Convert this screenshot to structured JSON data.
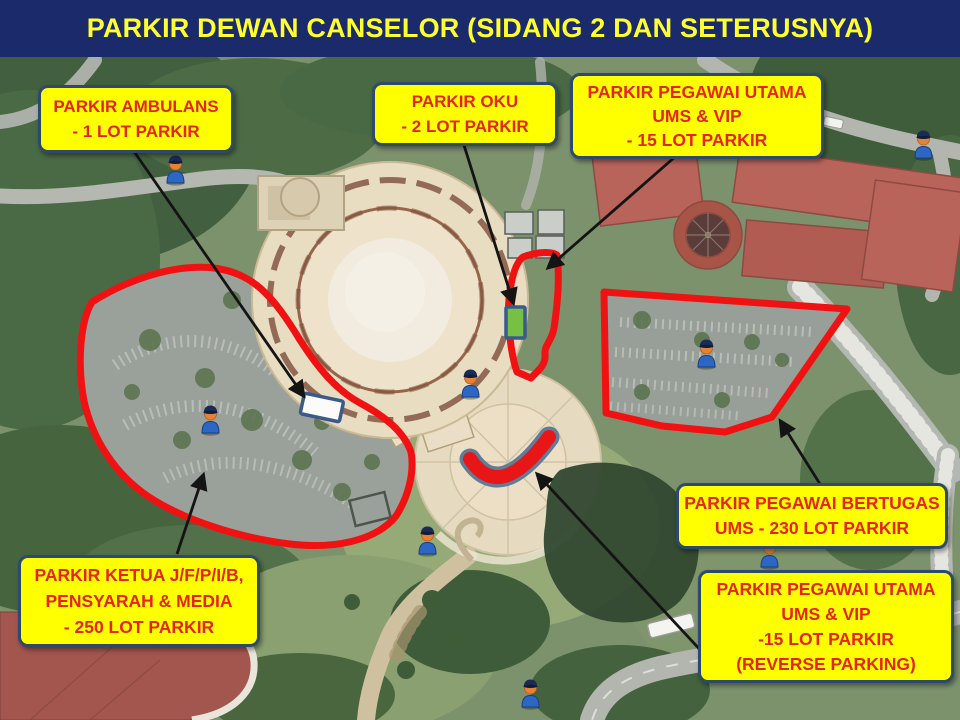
{
  "slide": {
    "title": "PARKIR DEWAN CANSELOR (SIDANG 2 DAN SETERUSNYA)"
  },
  "theme": {
    "header_bg": "#1b2a6b",
    "header_text": "#ffff2e",
    "callout_bg": "#ffff00",
    "callout_border": "#2e4a6b",
    "callout_text": "#e3261b",
    "zone_outline_red": "#f01212",
    "arrow_color": "#141414",
    "ambulans_bay_fill": "#fbfbf9",
    "oku_bay_fill": "#76c043",
    "bay_border": "#3a5a8c",
    "reverse_arc_fill": "#e81616",
    "reverse_arc_border": "#5f7d99"
  },
  "map": {
    "kind": "satellite-aerial",
    "callouts": [
      {
        "id": "ambulans",
        "lines": [
          "PARKIR AMBULANS",
          "- 1 LOT PARKIR"
        ]
      },
      {
        "id": "oku",
        "lines": [
          "PARKIR OKU",
          "- 2 LOT PARKIR"
        ]
      },
      {
        "id": "vip_top",
        "lines": [
          "PARKIR PEGAWAI UTAMA",
          "UMS & VIP",
          "- 15 LOT PARKIR"
        ]
      },
      {
        "id": "bertugas",
        "lines": [
          "PARKIR PEGAWAI BERTUGAS",
          "UMS - 230 LOT PARKIR"
        ]
      },
      {
        "id": "ketua",
        "lines": [
          "PARKIR  KETUA J/F/P/I/B,",
          "PENSYARAH & MEDIA",
          "- 250 LOT PARKIR"
        ]
      },
      {
        "id": "vip_reverse",
        "lines": [
          "PARKIR PEGAWAI UTAMA",
          "UMS & VIP",
          "-15 LOT PARKIR",
          "(REVERSE  PARKING)"
        ]
      }
    ],
    "icons": {
      "police_officer": {
        "name": "police-officer-icon",
        "count": 8
      }
    }
  }
}
